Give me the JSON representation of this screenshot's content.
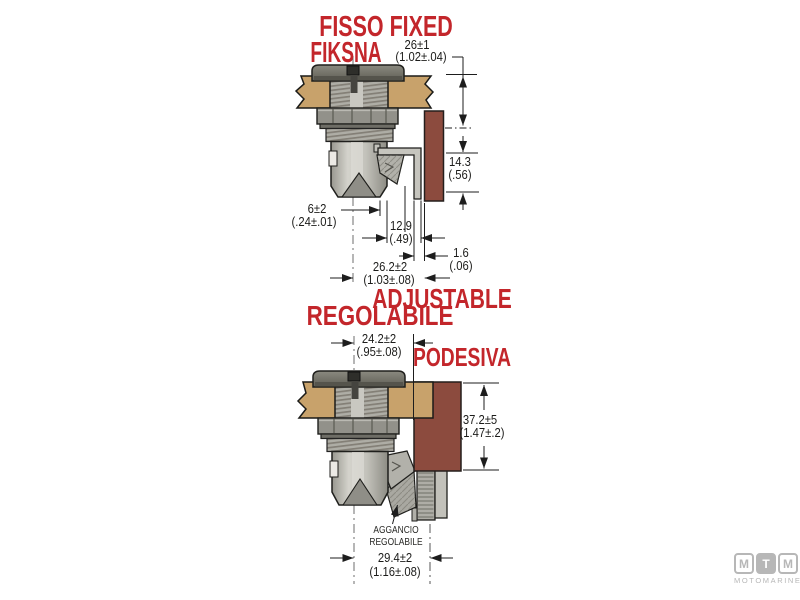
{
  "labels": {
    "fisso_fixed": "FISSO FIXED",
    "fiksna": "FIKSNA",
    "adjustable": "ADJUSTABLE",
    "regolabile": "REGOLABILE",
    "podesiva": "PODESIVA",
    "aggancio_line1": "AGGANCIO",
    "aggancio_line2": "REGOLABILE"
  },
  "dims": {
    "d26mm": "26±1",
    "d26in": "(1.02±.04)",
    "d143mm": "14.3",
    "d143in": "(.56)",
    "d6mm": "6±2",
    "d6in": "(.24±.01)",
    "d129mm": "12.9",
    "d129in": "(.49)",
    "d16mm": "1.6",
    "d16in": "(.06)",
    "d262mm": "26.2±2",
    "d262in": "(1.03±.08)",
    "d242mm": "24.2±2",
    "d242in": "(.95±.08)",
    "d372mm": "37.2±5",
    "d372in": "(1.47±.2)",
    "d294mm": "29.4±2",
    "d294in": "(1.16±.08)"
  },
  "logo": {
    "m1": "M",
    "t": "T",
    "m2": "M",
    "name": "MOTOMARINE"
  },
  "colors": {
    "label_red": "#c3262b",
    "panel_tan": "#c8a26b",
    "plate_maroon": "#8c4b3e",
    "logo_gray": "#b7b7b7"
  }
}
